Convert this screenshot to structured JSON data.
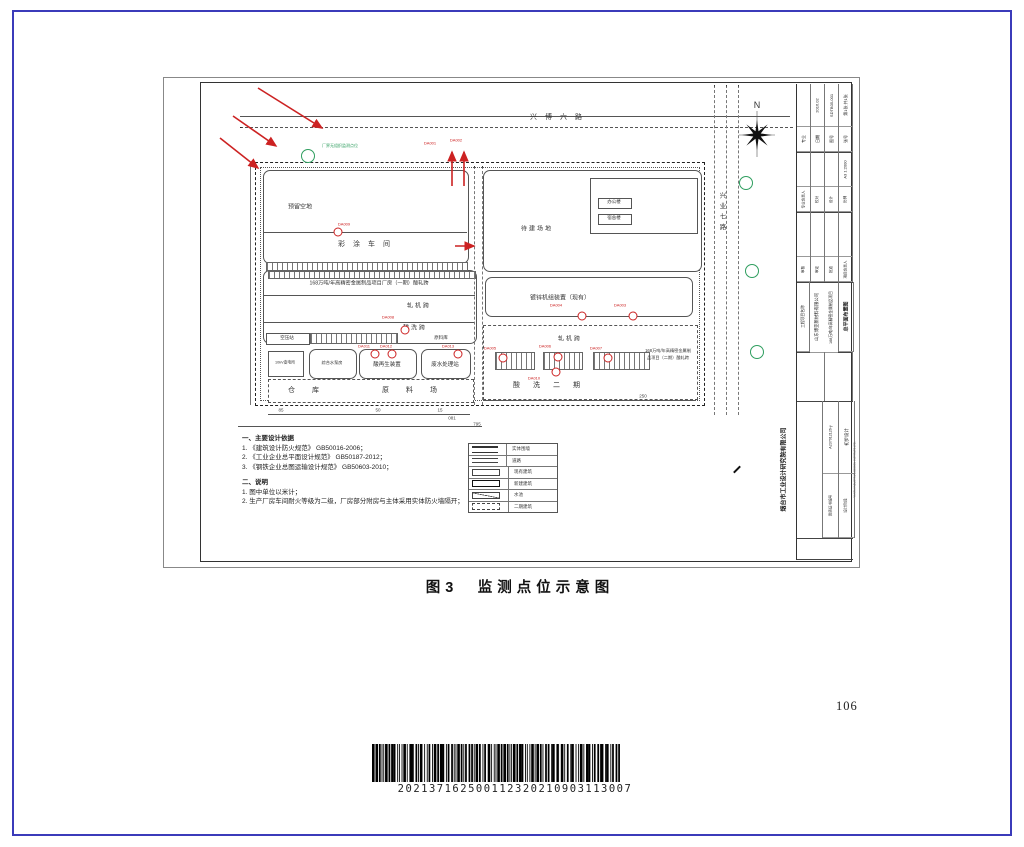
{
  "page": {
    "caption": "图3　监测点位示意图",
    "page_number": "106",
    "barcode_text": "202137162500112320210903113007"
  },
  "plan": {
    "labels": {
      "road_top": "兴博六路",
      "road_right": "兴业七路",
      "north_n": "N",
      "green_note": "厂界无组织监测点位",
      "yuliu": "预留空地",
      "caitu": "彩涂车间",
      "ph1": "168万吨/年高精密金属制品项目厂房（一期）酸轧跨",
      "zhaji1": "轧机跨",
      "suanxi1": "酸洗跨",
      "kongya": "空压站",
      "yuanliaoku": "原料库",
      "biandian": "10kV变电所",
      "zongshui": "综合水泵房",
      "suanzai": "酸再生装置",
      "feishui": "废水处理站",
      "cangku": "仓　库",
      "yuanliaochang": "原　料　场",
      "daijian": "待建场地",
      "bangong": "办公楼",
      "sushe": "宿舍楼",
      "duxin": "镀锌机组装置（现有）",
      "zhaji2": "轧机跨",
      "suanxi2": "酸　洗　二　期",
      "ph2_note": "168万吨/年高精密金属制品项目（二期）酸轧跨"
    },
    "monitor_points_red": [
      "DA001",
      "DA002",
      "DA003",
      "DA004",
      "DA005",
      "DA006",
      "DA007",
      "DA008",
      "DA009",
      "DA010",
      "DA011",
      "DA012",
      "DA013"
    ],
    "dimensions": [
      "85",
      "50",
      "15",
      "081",
      "795",
      "250"
    ],
    "colors": {
      "red": "#cc2222",
      "green": "#2f9e5f"
    }
  },
  "legend": {
    "items": [
      "实体围墙",
      "道路",
      "现有建筑",
      "新建建筑",
      "水池",
      "二期建筑"
    ]
  },
  "notes": {
    "sec1_title": "一、主要设计依据",
    "sec1": [
      "1. 《建筑设计防火规范》 GB50016-2006；",
      "2. 《工业企业总平面设计规范》 GB50187-2012；",
      "3. 《钢铁企业总图运输设计规范》 GB50603-2010；"
    ],
    "sec2_title": "二、说明",
    "sec2": [
      "1. 图中单位以米计；",
      "2. 生产厂房车间耐火等级为二级，厂房部分附房与主体采用实体防火墙隔开；"
    ]
  },
  "titleblock": {
    "rows1": {
      "c1l": "专业",
      "c2l": "日期",
      "c2v": "2016.02",
      "c3l": "图号",
      "c3v": "SDTB05-001",
      "c4l": "张号",
      "c4v": "第1张 共1张"
    },
    "rows2": {
      "c1l": "专业负责人",
      "c2l": "校对",
      "c3l": "设计",
      "c4l": "比例",
      "c4v": "A3 1:2000"
    },
    "rows3": {
      "c1l": "审核",
      "c2l": "审定",
      "c3l": "批准",
      "c4l": "项目负责人"
    },
    "project": {
      "label": "工程项目名称",
      "company": "山东博亚新材料有限公司",
      "project": "168万吨/年高精密金属制品项目",
      "drawing": "总平面布置图"
    },
    "firm": {
      "name": "烟台市工业设计研究院有限公司",
      "name_en": "YANTAI INDUSTRIAL DESIGN INSTITUTE LTD.",
      "cert_label": "资质证书编号",
      "cert_no": "A237012126-y",
      "stage_label": "设计阶段",
      "stage": "初步设计"
    }
  }
}
